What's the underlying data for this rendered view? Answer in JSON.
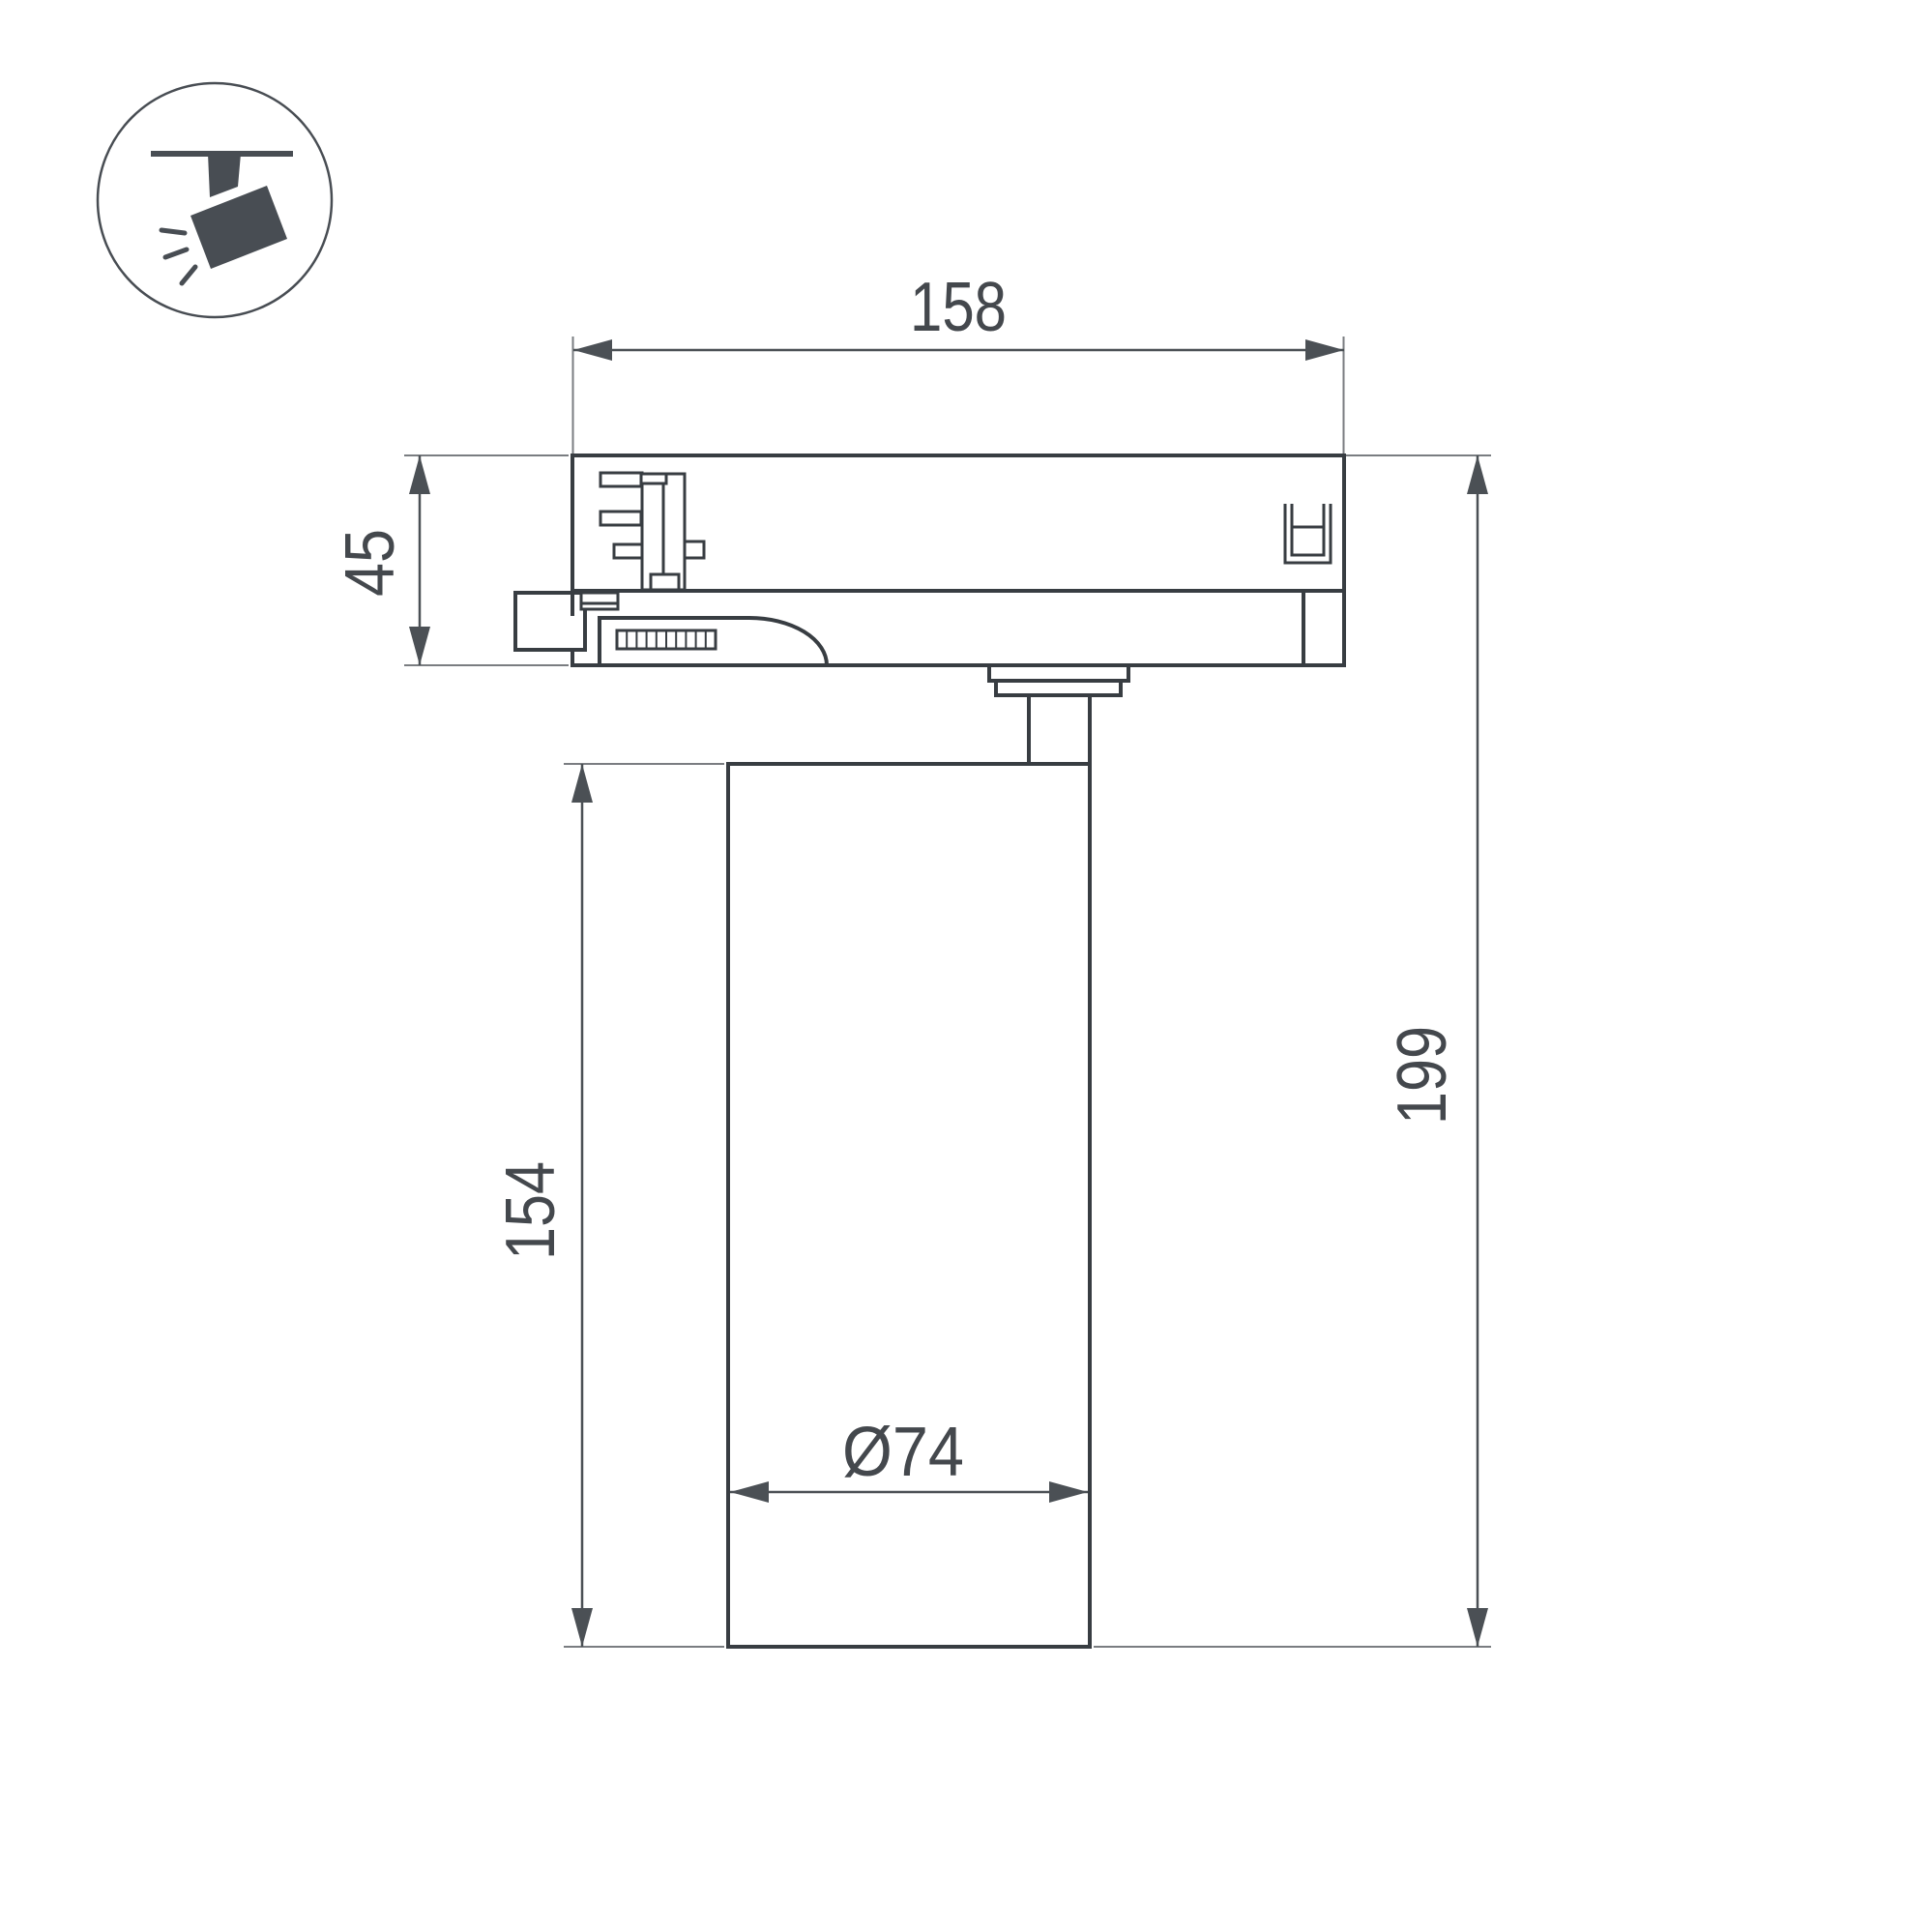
{
  "icon": {
    "name": "track-spotlight-icon"
  },
  "drawing": {
    "dims": {
      "adapter_width": "158",
      "adapter_height": "45",
      "body_height": "154",
      "total_height": "199",
      "body_diameter": "Ø74"
    },
    "colors": {
      "ink": "#383d42",
      "dimension": "#4b5055",
      "extension": "#7a7d81",
      "label": "#44484d",
      "background": "#ffffff"
    }
  }
}
